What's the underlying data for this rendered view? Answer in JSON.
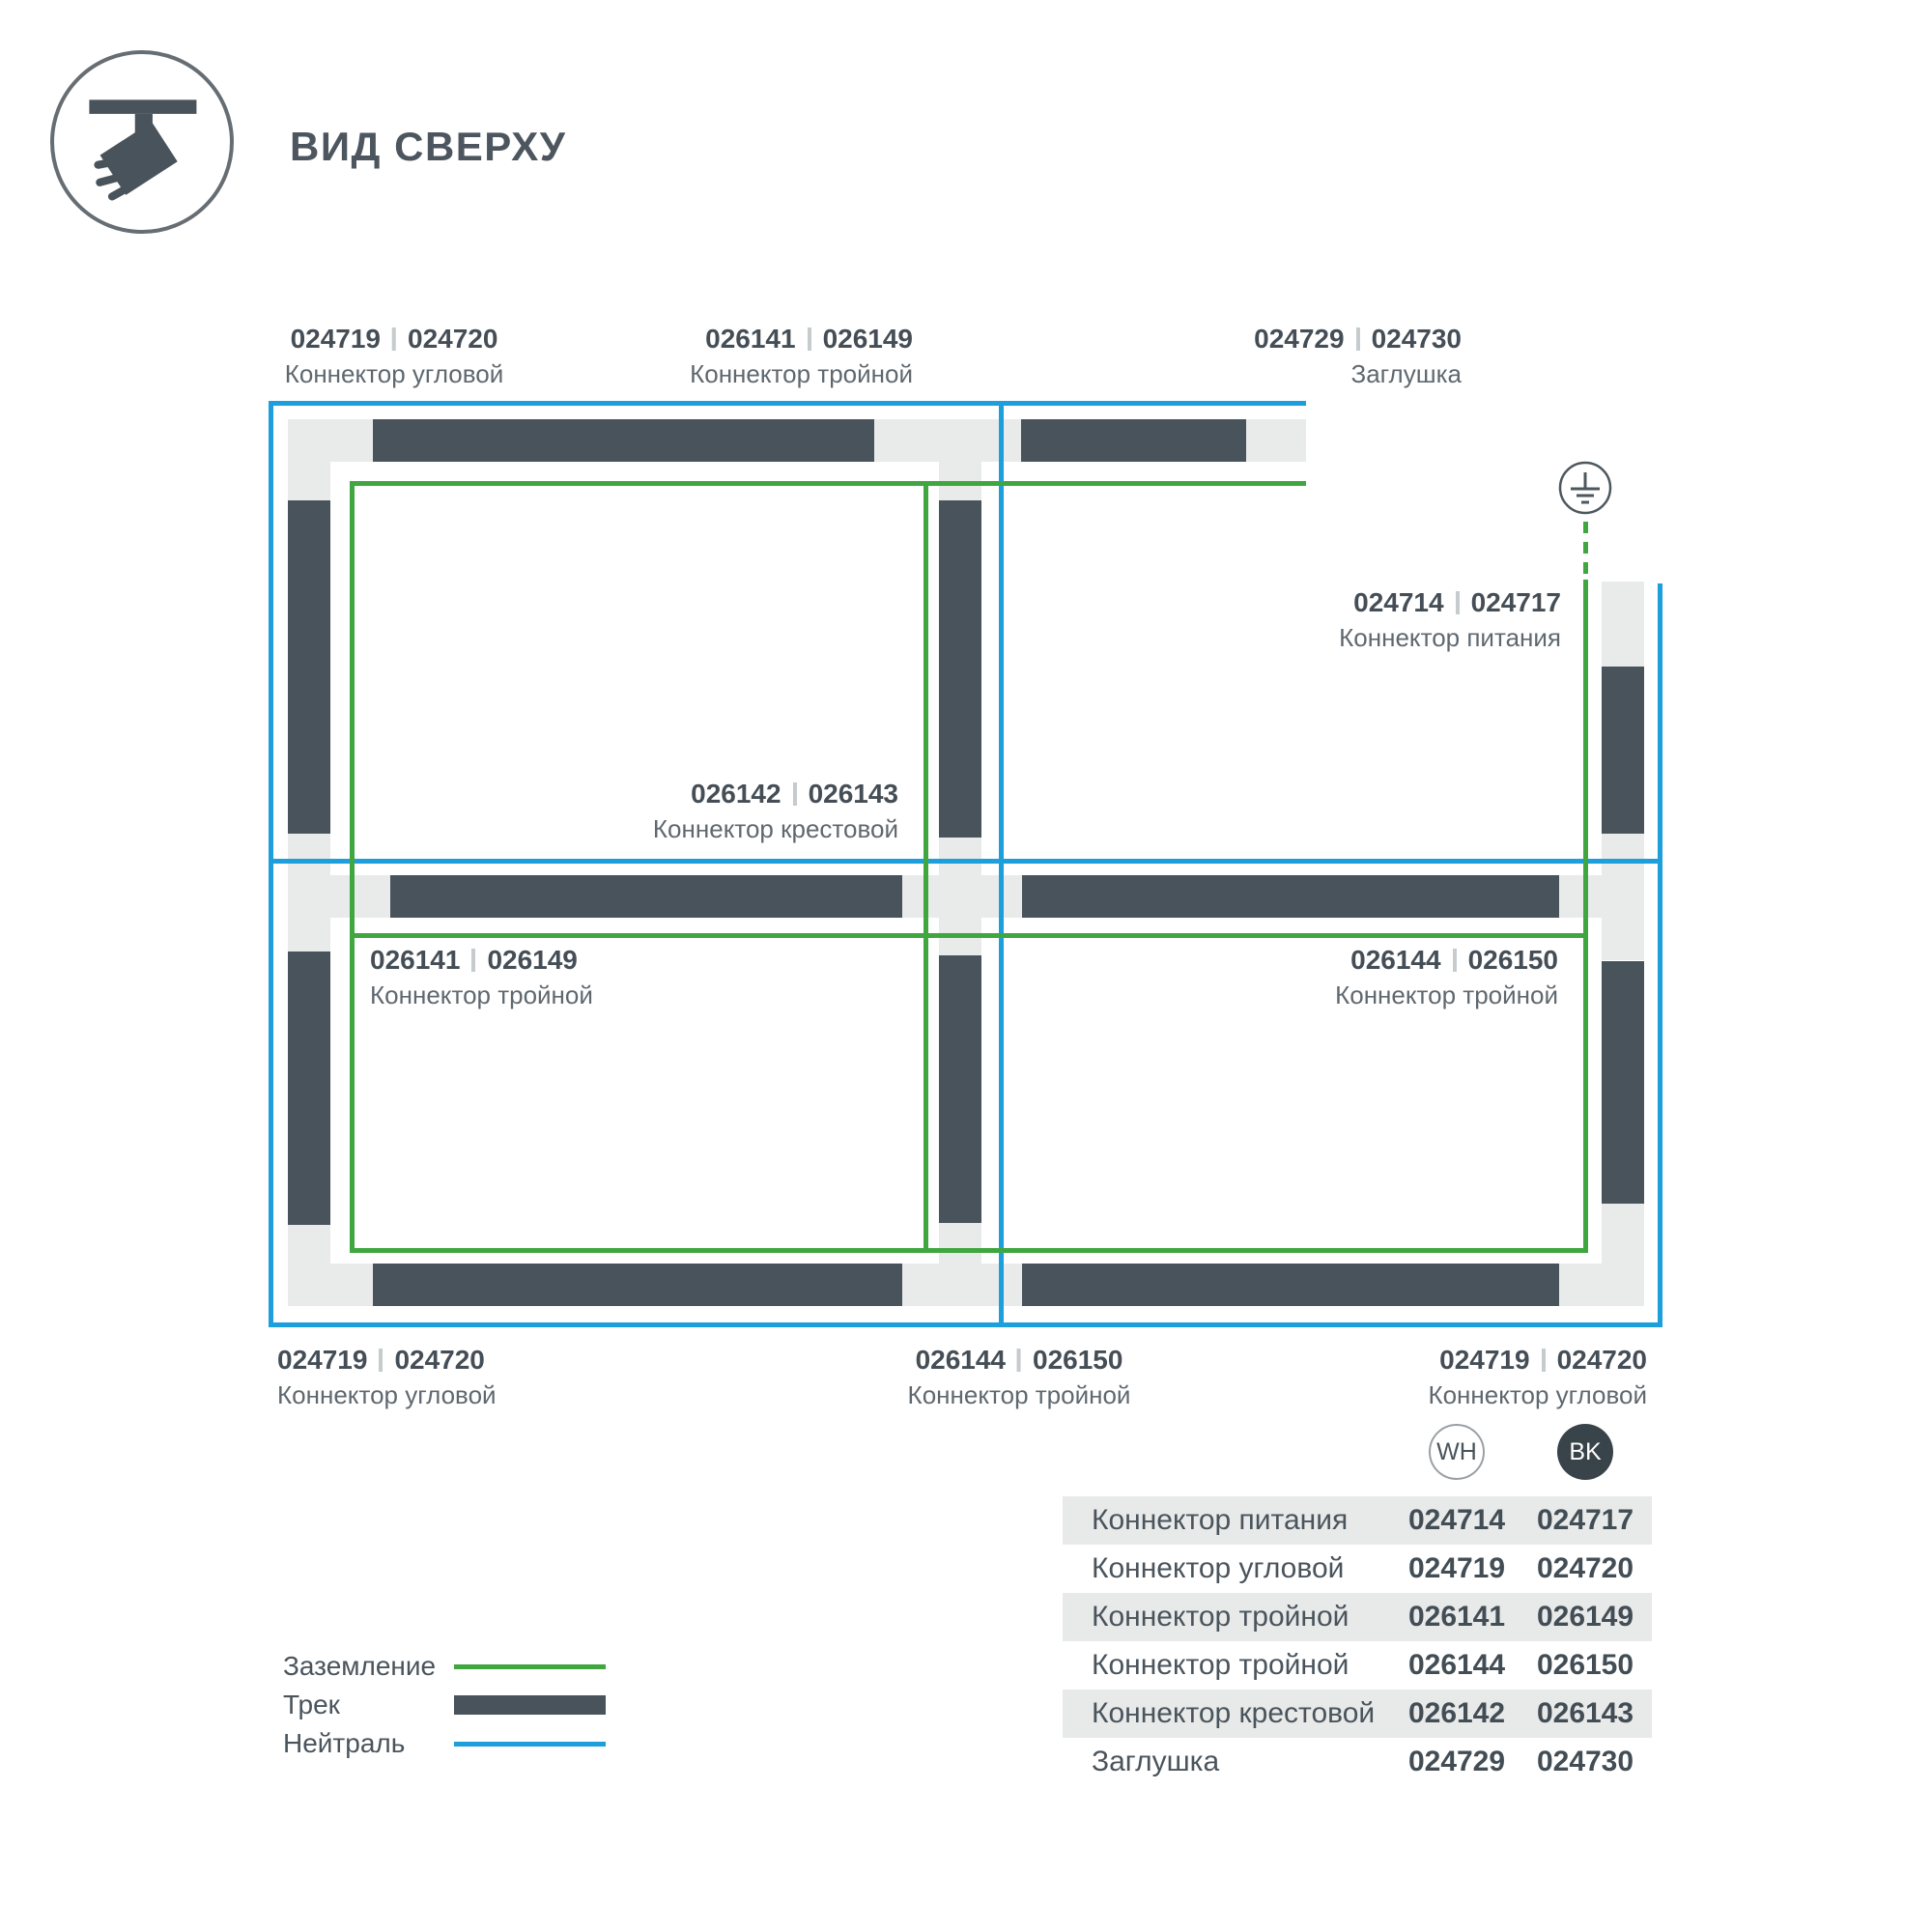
{
  "header": {
    "title": "ВИД СВЕРХУ"
  },
  "diagram": {
    "callouts": [
      {
        "id": "corner-top-left",
        "wh": "024719",
        "bk": "024720",
        "name": "Коннектор угловой"
      },
      {
        "id": "triple-top",
        "wh": "026141",
        "bk": "026149",
        "name": "Коннектор тройной"
      },
      {
        "id": "endcap-top",
        "wh": "024729",
        "bk": "024730",
        "name": "Заглушка"
      },
      {
        "id": "power-feed",
        "wh": "024714",
        "bk": "024717",
        "name": "Коннектор питания"
      },
      {
        "id": "cross-center",
        "wh": "026142",
        "bk": "026143",
        "name": "Коннектор крестовой"
      },
      {
        "id": "triple-left-cell",
        "wh": "026141",
        "bk": "026149",
        "name": "Коннектор тройной"
      },
      {
        "id": "triple-right-cell",
        "wh": "026144",
        "bk": "026150",
        "name": "Коннектор тройной"
      },
      {
        "id": "corner-bottom-left",
        "wh": "024719",
        "bk": "024720",
        "name": "Коннектор угловой"
      },
      {
        "id": "triple-bottom",
        "wh": "026144",
        "bk": "026150",
        "name": "Коннектор тройной"
      },
      {
        "id": "corner-bottom-right",
        "wh": "024719",
        "bk": "024720",
        "name": "Коннектор угловой"
      }
    ],
    "colors": {
      "track": "#49535B",
      "connector": "#E9EBEB",
      "ground": "#3FA640",
      "neutral": "#1C9FDB"
    }
  },
  "legend": {
    "items": [
      {
        "label": "Заземление",
        "type": "ground-line",
        "color": "#3FA640"
      },
      {
        "label": "Трек",
        "type": "track-bar",
        "color": "#49535B"
      },
      {
        "label": "Нейтраль",
        "type": "neutral-line",
        "color": "#1C9FDB"
      }
    ]
  },
  "table": {
    "col_wh": "WH",
    "col_bk": "BK",
    "rows": [
      {
        "name": "Коннектор питания",
        "wh": "024714",
        "bk": "024717"
      },
      {
        "name": "Коннектор угловой",
        "wh": "024719",
        "bk": "024720"
      },
      {
        "name": "Коннектор тройной",
        "wh": "026141",
        "bk": "026149"
      },
      {
        "name": "Коннектор тройной",
        "wh": "026144",
        "bk": "026150"
      },
      {
        "name": "Коннектор крестовой",
        "wh": "026142",
        "bk": "026143"
      },
      {
        "name": "Заглушка",
        "wh": "024729",
        "bk": "024730"
      }
    ]
  }
}
